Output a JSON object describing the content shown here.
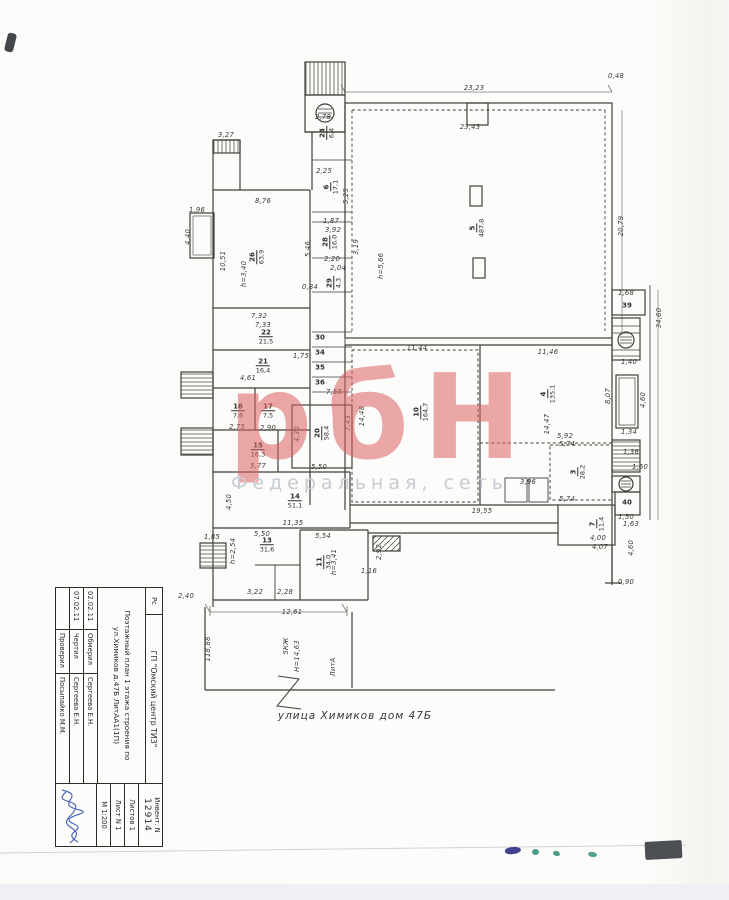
{
  "watermark": {
    "text": "рбН",
    "subtext": "Федеральная, сеть",
    "color": "#db6060",
    "subcolor": "#c7ccd3"
  },
  "street_label": "улица Химиков дом 47Б",
  "titleblock": {
    "corner": "Рс",
    "org": "ГП \"Омский центр ТИЗ\"",
    "doc_title": "Поэтажный план 1 этажа строения по ул.Химиков д.47Б ЛитАА1(1П)",
    "rows": [
      {
        "date": "02.02.11",
        "role": "Обмерил",
        "name": "Сергеева Е.Н."
      },
      {
        "date": "07.02.11",
        "role": "Чертил",
        "name": "Сергеева Е.Н."
      },
      {
        "date": "",
        "role": "Проверил",
        "name": "Посыпайко М.М."
      }
    ],
    "inv_label": "Инвент. N",
    "inv_number": "12914",
    "sheets": "Листов 1",
    "sheet": "Лист N 1",
    "scale": "М 1:200"
  },
  "plan": {
    "labels": [
      {
        "t": "23,23",
        "x": 474,
        "y": 88
      },
      {
        "t": "23,43",
        "x": 470,
        "y": 127
      },
      {
        "t": "0,48",
        "x": 616,
        "y": 76
      },
      {
        "t": "3,27",
        "x": 226,
        "y": 135
      },
      {
        "t": "2,78",
        "x": 323,
        "y": 117
      },
      {
        "t": "2,25",
        "x": 324,
        "y": 171
      },
      {
        "t": "8,76",
        "x": 263,
        "y": 201
      },
      {
        "t": "1,96",
        "x": 197,
        "y": 210
      },
      {
        "t": "4,40",
        "x": 188,
        "y": 237,
        "r": 90
      },
      {
        "t": "10,51",
        "x": 223,
        "y": 261,
        "r": 90
      },
      {
        "t": "20,79",
        "x": 621,
        "y": 226,
        "r": 90
      },
      {
        "t": "34,60",
        "x": 659,
        "y": 318,
        "r": 90
      },
      {
        "t": "1,87",
        "x": 331,
        "y": 221
      },
      {
        "t": "3,92",
        "x": 333,
        "y": 230
      },
      {
        "t": "5,25",
        "x": 346,
        "y": 196,
        "r": 90
      },
      {
        "t": "3,19",
        "x": 356,
        "y": 247,
        "r": 90
      },
      {
        "t": "5,46",
        "x": 308,
        "y": 249,
        "r": 90
      },
      {
        "t": "2,20",
        "x": 332,
        "y": 259
      },
      {
        "t": "2,04",
        "x": 338,
        "y": 268
      },
      {
        "t": "0,84",
        "x": 310,
        "y": 287
      },
      {
        "t": "7,32",
        "x": 259,
        "y": 316
      },
      {
        "t": "7,33",
        "x": 263,
        "y": 325
      },
      {
        "t": "1,75",
        "x": 301,
        "y": 356
      },
      {
        "t": "4,61",
        "x": 248,
        "y": 378
      },
      {
        "t": "7,55",
        "x": 334,
        "y": 392
      },
      {
        "t": "2,75",
        "x": 237,
        "y": 427
      },
      {
        "t": "2,90",
        "x": 268,
        "y": 428
      },
      {
        "t": "5,77",
        "x": 258,
        "y": 466
      },
      {
        "t": "4,50",
        "x": 229,
        "y": 502,
        "r": 90
      },
      {
        "t": "11,35",
        "x": 293,
        "y": 523
      },
      {
        "t": "5,50",
        "x": 262,
        "y": 534
      },
      {
        "t": "5,54",
        "x": 323,
        "y": 536
      },
      {
        "t": "5,50",
        "x": 319,
        "y": 467
      },
      {
        "t": "4,30",
        "x": 297,
        "y": 434,
        "r": 90
      },
      {
        "t": "7,43",
        "x": 348,
        "y": 423,
        "r": 90
      },
      {
        "t": "14,48",
        "x": 362,
        "y": 416,
        "r": 90
      },
      {
        "t": "11,44",
        "x": 417,
        "y": 348
      },
      {
        "t": "14,47",
        "x": 547,
        "y": 424,
        "r": 90
      },
      {
        "t": "11,46",
        "x": 548,
        "y": 352
      },
      {
        "t": "8,07",
        "x": 608,
        "y": 396,
        "r": 90
      },
      {
        "t": "5,92",
        "x": 565,
        "y": 436
      },
      {
        "t": "5,74",
        "x": 567,
        "y": 444
      },
      {
        "t": "5,74",
        "x": 567,
        "y": 499
      },
      {
        "t": "19,55",
        "x": 482,
        "y": 511
      },
      {
        "t": "3,96",
        "x": 528,
        "y": 482
      },
      {
        "t": "1,68",
        "x": 626,
        "y": 293
      },
      {
        "t": "1,40",
        "x": 629,
        "y": 362
      },
      {
        "t": "4,60",
        "x": 643,
        "y": 400,
        "r": 90
      },
      {
        "t": "1,34",
        "x": 629,
        "y": 432
      },
      {
        "t": "1,36",
        "x": 631,
        "y": 452
      },
      {
        "t": "1,60",
        "x": 640,
        "y": 467
      },
      {
        "t": "1,50",
        "x": 626,
        "y": 517
      },
      {
        "t": "1,63",
        "x": 631,
        "y": 524
      },
      {
        "t": "4,60",
        "x": 631,
        "y": 548,
        "r": 90
      },
      {
        "t": "0,90",
        "x": 626,
        "y": 582
      },
      {
        "t": "4,00",
        "x": 598,
        "y": 538
      },
      {
        "t": "4,07",
        "x": 600,
        "y": 547
      },
      {
        "t": "2,92",
        "x": 379,
        "y": 552,
        "r": 90
      },
      {
        "t": "1,16",
        "x": 369,
        "y": 571
      },
      {
        "t": "1,85",
        "x": 212,
        "y": 537
      },
      {
        "t": "2,40",
        "x": 186,
        "y": 596
      },
      {
        "t": "3,22",
        "x": 255,
        "y": 592
      },
      {
        "t": "2,28",
        "x": 285,
        "y": 592
      },
      {
        "t": "12,61",
        "x": 292,
        "y": 612
      },
      {
        "t": "118,88",
        "x": 208,
        "y": 649,
        "r": 90,
        "name": "yard-length-dimension"
      },
      {
        "t": "5КЖ",
        "x": 286,
        "y": 646,
        "r": 90,
        "name": "building-storeys-note"
      },
      {
        "t": "Н=14,63",
        "x": 297,
        "y": 656,
        "r": 90,
        "name": "building-height-note"
      },
      {
        "t": "ЛитА",
        "x": 333,
        "y": 667,
        "r": 90,
        "name": "liter-note"
      },
      {
        "t": "h=3,40",
        "x": 244,
        "y": 274,
        "r": 90,
        "name": "ceiling-height-label"
      },
      {
        "t": "h=5,66",
        "x": 381,
        "y": 266,
        "r": 90,
        "name": "ceiling-height-label"
      },
      {
        "t": "h=3,41",
        "x": 334,
        "y": 562,
        "r": 90,
        "name": "ceiling-height-label"
      },
      {
        "t": "h=2,54",
        "x": 233,
        "y": 551,
        "r": 90,
        "name": "ceiling-height-label"
      }
    ],
    "rooms": [
      {
        "n": "5",
        "a": "487,8",
        "x": 477,
        "y": 228,
        "r": 90
      },
      {
        "n": "10",
        "a": "164,7",
        "x": 421,
        "y": 412,
        "r": 90
      },
      {
        "n": "4",
        "a": "135,1",
        "x": 548,
        "y": 394,
        "r": 90
      },
      {
        "n": "3",
        "a": "28,2",
        "x": 578,
        "y": 472,
        "r": 90
      },
      {
        "n": "7",
        "a": "11,4",
        "x": 597,
        "y": 524,
        "r": 90
      },
      {
        "n": "26",
        "a": "63,9",
        "x": 257,
        "y": 257,
        "r": 90
      },
      {
        "n": "20",
        "a": "58,4",
        "x": 322,
        "y": 433,
        "r": 90
      },
      {
        "n": "11",
        "a": "34,0",
        "x": 324,
        "y": 562,
        "r": 90
      },
      {
        "n": "22",
        "a": "21,5",
        "x": 266,
        "y": 337
      },
      {
        "n": "21",
        "a": "16,4",
        "x": 263,
        "y": 366
      },
      {
        "n": "16",
        "a": "7,6",
        "x": 238,
        "y": 411
      },
      {
        "n": "17",
        "a": "7,5",
        "x": 268,
        "y": 411
      },
      {
        "n": "15",
        "a": "16,3",
        "x": 258,
        "y": 450
      },
      {
        "n": "14",
        "a": "51,1",
        "x": 295,
        "y": 501
      },
      {
        "n": "13",
        "a": "31,6",
        "x": 267,
        "y": 545
      },
      {
        "n": "6",
        "a": "17,1",
        "x": 331,
        "y": 187,
        "r": 90
      },
      {
        "n": "28",
        "a": "16,0",
        "x": 330,
        "y": 242,
        "r": 90
      },
      {
        "n": "24",
        "a": "6,4",
        "x": 327,
        "y": 133,
        "r": 90
      },
      {
        "n": "29",
        "a": "4,3",
        "x": 334,
        "y": 283,
        "r": 90
      },
      {
        "n": "39",
        "a": "",
        "x": 627,
        "y": 306
      },
      {
        "n": "40",
        "a": "",
        "x": 627,
        "y": 503
      },
      {
        "n": "30",
        "a": "",
        "x": 320,
        "y": 338
      },
      {
        "n": "34",
        "a": "",
        "x": 320,
        "y": 353
      },
      {
        "n": "35",
        "a": "",
        "x": 320,
        "y": 368
      },
      {
        "n": "36",
        "a": "",
        "x": 320,
        "y": 383
      }
    ]
  }
}
